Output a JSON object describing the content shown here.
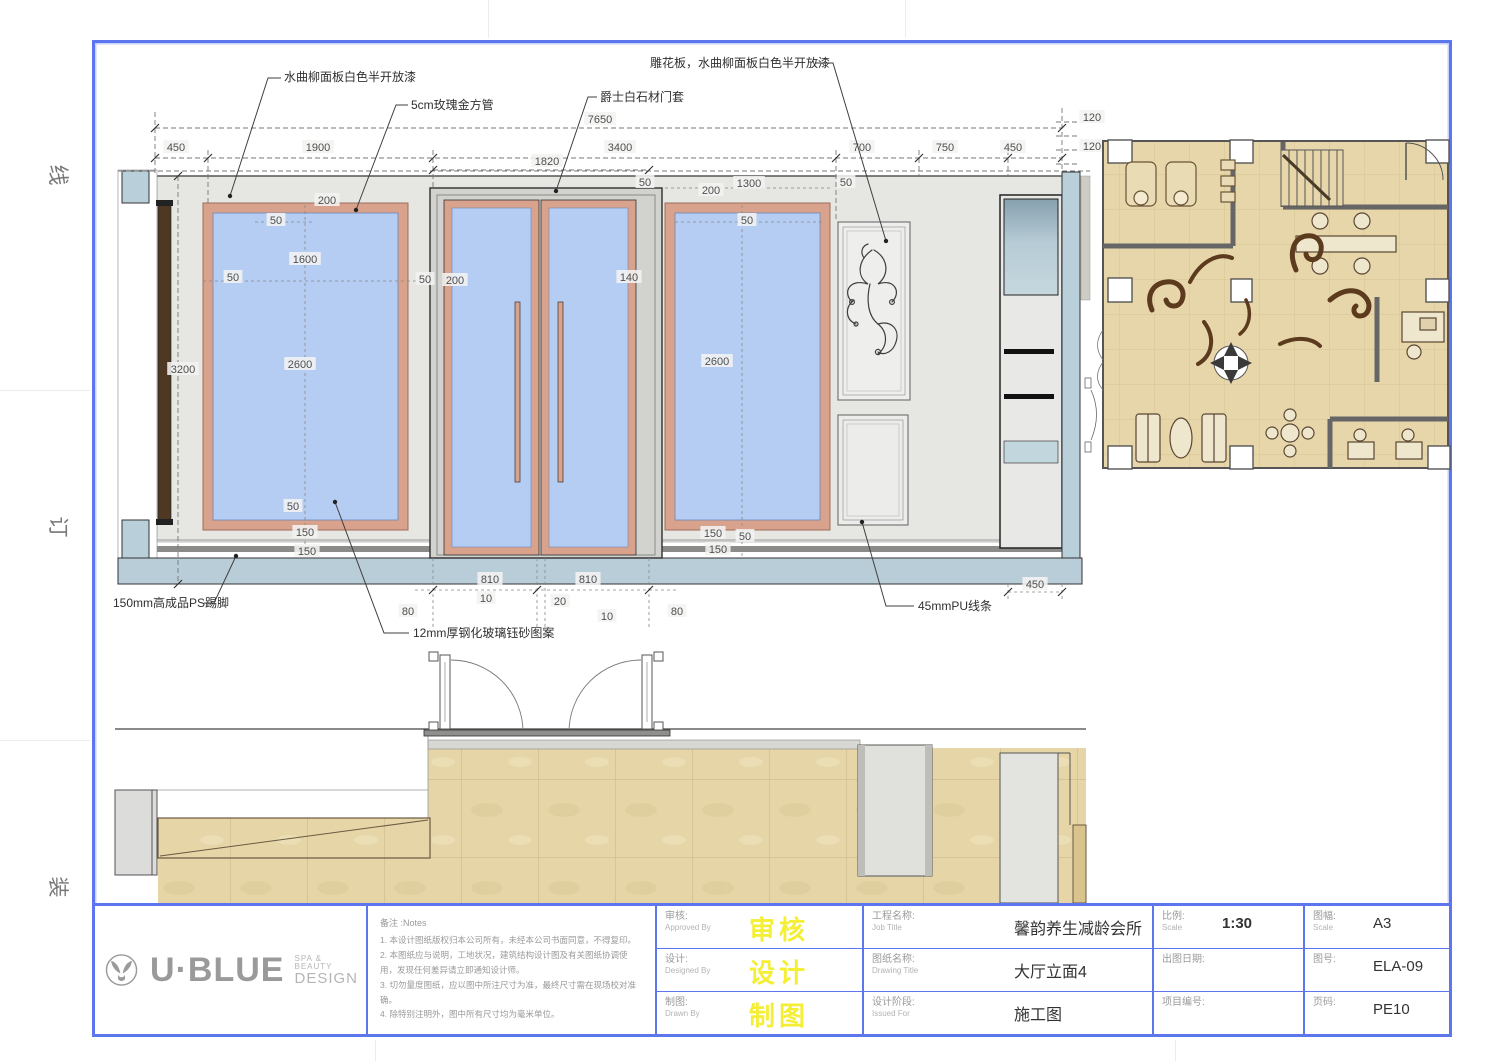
{
  "page": {
    "margin_marks": [
      "线",
      "订",
      "装"
    ]
  },
  "colors": {
    "frame_blue": "#5c76ee",
    "glass_blue": "#b6cdf3",
    "rose_gold": "#d8a28c",
    "wall_gray": "#e6e6e3",
    "base_band": "#b9cdd8",
    "floor_beige": "#e6d6aa",
    "swirl_brown": "#5b3a1d",
    "stamp_yellow": "#f4ee35"
  },
  "elevation": {
    "annotations": [
      {
        "text": "水曲柳面板白色半开放漆",
        "tx": 284,
        "ty": 81,
        "line": [
          [
            230,
            196
          ],
          [
            268,
            78
          ],
          [
            281,
            78
          ]
        ],
        "dot": [
          230,
          196
        ]
      },
      {
        "text": "5cm玫瑰金方管",
        "tx": 411,
        "ty": 109,
        "line": [
          [
            356,
            210
          ],
          [
            396,
            105
          ],
          [
            408,
            105
          ]
        ],
        "dot": [
          356,
          210
        ]
      },
      {
        "text": "爵士白石材门套",
        "tx": 600,
        "ty": 101,
        "line": [
          [
            556,
            191
          ],
          [
            588,
            97
          ],
          [
            597,
            97
          ]
        ],
        "dot": [
          556,
          191
        ]
      },
      {
        "text": "雕花板，水曲柳面板白色半开放漆",
        "tx": 650,
        "ty": 67,
        "line": [
          [
            815,
            63
          ],
          [
            833,
            63
          ],
          [
            886,
            241
          ]
        ],
        "dot": [
          886,
          241
        ]
      },
      {
        "text": "150mm高成品PS踢脚",
        "tx": 113,
        "ty": 607,
        "line": [
          [
            236,
            556
          ],
          [
            214,
            603
          ],
          [
            204,
            603
          ]
        ],
        "dot": [
          236,
          556
        ]
      },
      {
        "text": "12mm厚钢化玻璃钰砂图案",
        "tx": 413,
        "ty": 637,
        "line": [
          [
            335,
            502
          ],
          [
            384,
            633
          ],
          [
            409,
            633
          ]
        ],
        "dot": [
          335,
          502
        ]
      },
      {
        "text": "45mmPU线条",
        "tx": 918,
        "ty": 610,
        "line": [
          [
            862,
            522
          ],
          [
            886,
            606
          ],
          [
            914,
            606
          ]
        ],
        "dot": [
          862,
          522
        ]
      }
    ],
    "dims": [
      {
        "t": "7650",
        "x": 600,
        "y": 121
      },
      {
        "t": "450",
        "x": 176,
        "y": 149
      },
      {
        "t": "1900",
        "x": 318,
        "y": 149
      },
      {
        "t": "3400",
        "x": 620,
        "y": 149
      },
      {
        "t": "700",
        "x": 862,
        "y": 149
      },
      {
        "t": "750",
        "x": 945,
        "y": 149
      },
      {
        "t": "450",
        "x": 1013,
        "y": 149
      },
      {
        "t": "120",
        "x": 1092,
        "y": 119
      },
      {
        "t": "120",
        "x": 1092,
        "y": 148
      },
      {
        "t": "1820",
        "x": 547,
        "y": 163
      },
      {
        "t": "200",
        "x": 327,
        "y": 202
      },
      {
        "t": "50",
        "x": 276,
        "y": 222
      },
      {
        "t": "1600",
        "x": 305,
        "y": 261
      },
      {
        "t": "50",
        "x": 233,
        "y": 279
      },
      {
        "t": "2600",
        "x": 300,
        "y": 366
      },
      {
        "t": "3200",
        "x": 183,
        "y": 371
      },
      {
        "t": "50",
        "x": 293,
        "y": 508
      },
      {
        "t": "150",
        "x": 305,
        "y": 534
      },
      {
        "t": "150",
        "x": 307,
        "y": 553
      },
      {
        "t": "50",
        "x": 425,
        "y": 281
      },
      {
        "t": "200",
        "x": 455,
        "y": 282
      },
      {
        "t": "140",
        "x": 629,
        "y": 279
      },
      {
        "t": "50",
        "x": 645,
        "y": 184
      },
      {
        "t": "50",
        "x": 846,
        "y": 184
      },
      {
        "t": "1300",
        "x": 749,
        "y": 185
      },
      {
        "t": "200",
        "x": 711,
        "y": 192
      },
      {
        "t": "50",
        "x": 747,
        "y": 222
      },
      {
        "t": "2600",
        "x": 717,
        "y": 363
      },
      {
        "t": "150",
        "x": 713,
        "y": 535
      },
      {
        "t": "50",
        "x": 745,
        "y": 538
      },
      {
        "t": "150",
        "x": 718,
        "y": 551
      },
      {
        "t": "450",
        "x": 1035,
        "y": 586
      },
      {
        "t": "810",
        "x": 490,
        "y": 581
      },
      {
        "t": "810",
        "x": 588,
        "y": 581
      },
      {
        "t": "10",
        "x": 486,
        "y": 600
      },
      {
        "t": "20",
        "x": 560,
        "y": 603
      },
      {
        "t": "10",
        "x": 607,
        "y": 618
      },
      {
        "t": "80",
        "x": 408,
        "y": 613
      },
      {
        "t": "80",
        "x": 677,
        "y": 613
      }
    ]
  },
  "title_block": {
    "logo": {
      "brand": "U·BLUE",
      "tagline1": "SPA & BEAUTY",
      "tagline2": "DESIGN"
    },
    "notes": {
      "label": "备注 :Notes",
      "items": [
        "1. 本设计图纸版权归本公司所有，未经本公司书面同意，不得复印。",
        "2. 本图纸应与说明，工地状况，建筑结构设计图及有关图纸协调使用，发现任何差异请立即通知设计师。",
        "3. 切勿量度图纸，应以图中所注尺寸为准，最终尺寸需在现场校对准确。",
        "4. 除特别注明外，图中所有尺寸均为毫米单位。"
      ]
    },
    "sign_rows": [
      {
        "label": "审核:",
        "label_en": "Approved By",
        "stamp": "审核"
      },
      {
        "label": "设计:",
        "label_en": "Designed By",
        "stamp": "设计"
      },
      {
        "label": "制图:",
        "label_en": "Drawn By",
        "stamp": "制图"
      }
    ],
    "info_rows": [
      {
        "label": "工程名称:",
        "label_en": "Job Title",
        "value": "馨韵养生减龄会所"
      },
      {
        "label": "图纸名称:",
        "label_en": "Drawing Title",
        "value": "大厅立面4"
      },
      {
        "label": "设计阶段:",
        "label_en": "Issued For",
        "value": "施工图"
      }
    ],
    "scale_rows": [
      {
        "label": "比例:",
        "label_en": "Scale",
        "value": "1:30"
      },
      {
        "label": "出图日期:",
        "label_en": "",
        "value": ""
      },
      {
        "label": "项目编号:",
        "label_en": "",
        "value": ""
      }
    ],
    "right_rows": [
      {
        "label": "图幅:",
        "label_en": "Scale",
        "value": "A3"
      },
      {
        "label": "图号:",
        "label_en": "",
        "value": "ELA-09"
      },
      {
        "label": "页码:",
        "label_en": "",
        "value": "PE10"
      }
    ]
  }
}
